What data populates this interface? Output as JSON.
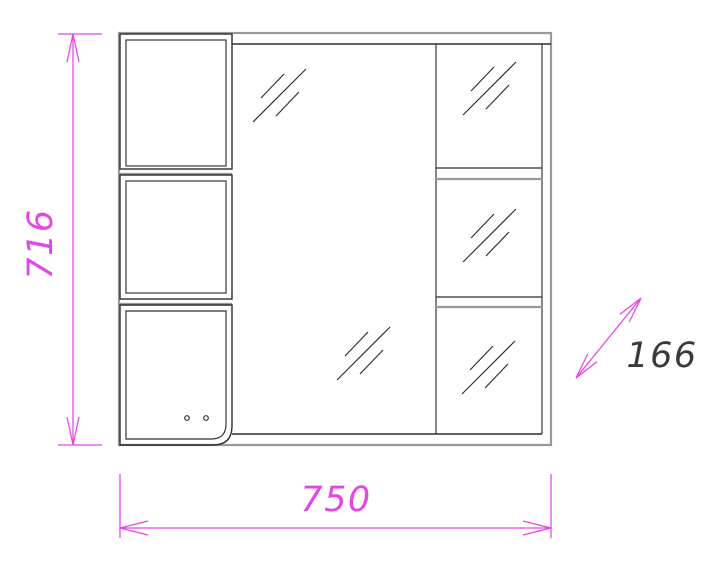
{
  "page": {
    "background": "#ffffff"
  },
  "drawing": {
    "type": "furniture-technical-drawing",
    "subject": "mirror-cabinet-front-view",
    "dimension_labels": {
      "height": "716",
      "width": "750",
      "depth": "166"
    },
    "colors": {
      "dimension_lines": "#e545e5",
      "outline_gray": "#999999",
      "line_black": "#2e2e2e",
      "depth_label_text": "#3a3a3a",
      "background": "#ffffff"
    }
  }
}
